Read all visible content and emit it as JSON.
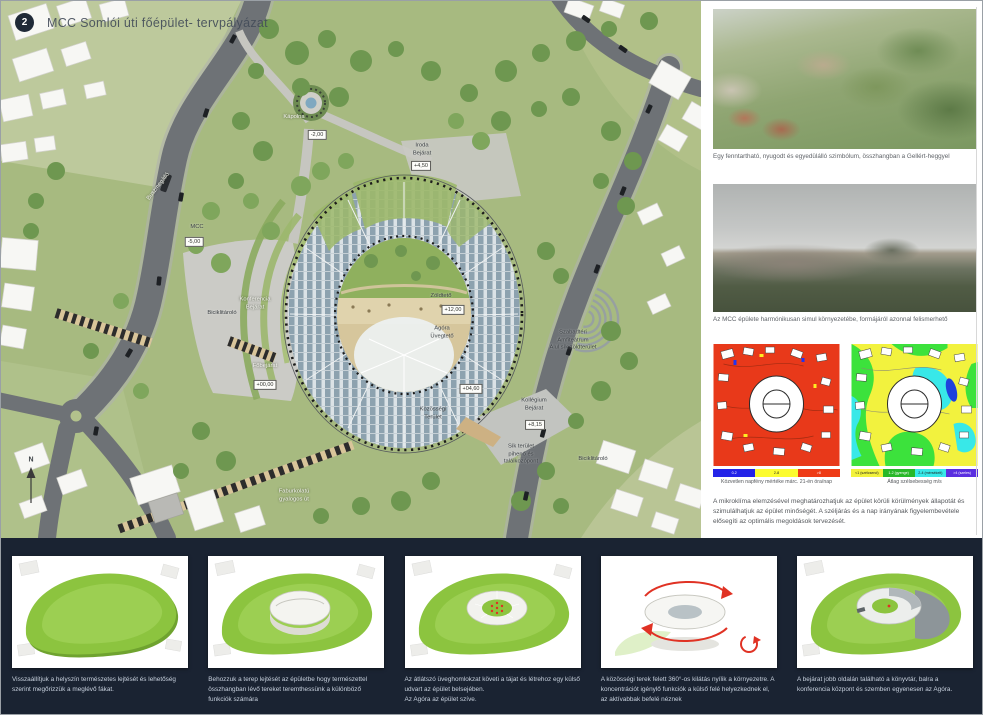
{
  "board": {
    "badge": "2",
    "title": "MCC Somlói úti főépület- tervpályázat"
  },
  "siteplan": {
    "labels": {
      "busz": "Buszmegálló",
      "mcc": "MCC",
      "mcc_elev": "-5,00",
      "bicikli_left": "Biciklitároló",
      "konferencia": "Konferencia\nBejárat",
      "fobejarat": "Főbejárat",
      "fobejarat_elev": "+00,00",
      "zoldteto": "Zöldtető",
      "zoldteto_elev": "+12,00",
      "agora": "Agóra\nÜvegtető",
      "agora_elev": "+04,60",
      "kozossegi": "Közösségi\nTerület",
      "kollegium": "Kollégium\nBejárat",
      "kollegium_elev": "+8,15",
      "amfiteatrum": "Szabadtéri\nAmfiteátrum\nAlul sík zöldterület",
      "sik": "Sík terület\npihenő és\ntalálkozópont",
      "bicikli_right": "Biciklitároló",
      "faburkolat": "Faburkolatú\ngyalogos út",
      "kapolna": "Kápolna",
      "kapolna_elev": "-2,00",
      "iroda": "Iroda\nBejárat",
      "iroda_elev": "+4,50",
      "compass": "N"
    }
  },
  "right_column": {
    "photos": [
      {
        "caption": "Egy fenntartható, nyugodt és egyedülálló szimbólum, összhangban a Gellért-heggyel"
      },
      {
        "caption": "Az MCC épülete harmónikusan simul környezetébe, formájáról azonnal felismerhető"
      }
    ],
    "simulations": {
      "sun": {
        "caption": "Közvetlen napfény mértéke márc. 21-én óra/nap",
        "legend": [
          "0-2",
          "2-8",
          ">8"
        ]
      },
      "wind": {
        "caption": "Átlag szélsebesség m/s",
        "legend": [
          "<1 (szélcsend)",
          "1-2 (gyenge)",
          "2-4 (mérsékelt)",
          ">4 (szeles)"
        ]
      }
    },
    "paragraph": "A mikroklíma elemzésével meghatározhatjuk az épület körüli körülmények állapotát és szimulálhatjuk az épület minőségét. A széljárás és a nap irányának figyelembevétele elősegíti az optimális megoldások tervezését."
  },
  "bottom": {
    "cards": [
      {
        "caption": "Visszaállítjuk a helyszín természetes lejtését és lehetőség szerint megőrizzük a meglévő fákat."
      },
      {
        "caption": "Behozzuk a terep lejtését az épületbe hogy természettel összhangban lévő tereket teremthessünk a különböző funkciók számára"
      },
      {
        "caption": "Az átlátszó üveghomlokzat követi a tájat és létrehoz egy külső udvart az épület belsejében.\nAz Agóra az épület szíve."
      },
      {
        "caption": "A közösségi terek felett 360°-os kilátás nyílik a környezetre. A koncentrációt igénylő funkciók a külső felé helyezkednek el, az aktívabbak befelé néznek"
      },
      {
        "caption": "A bejárat jobb oldalán található a könyvtár, balra a konferencia központ és szemben egyenesen az Agóra."
      }
    ]
  }
}
